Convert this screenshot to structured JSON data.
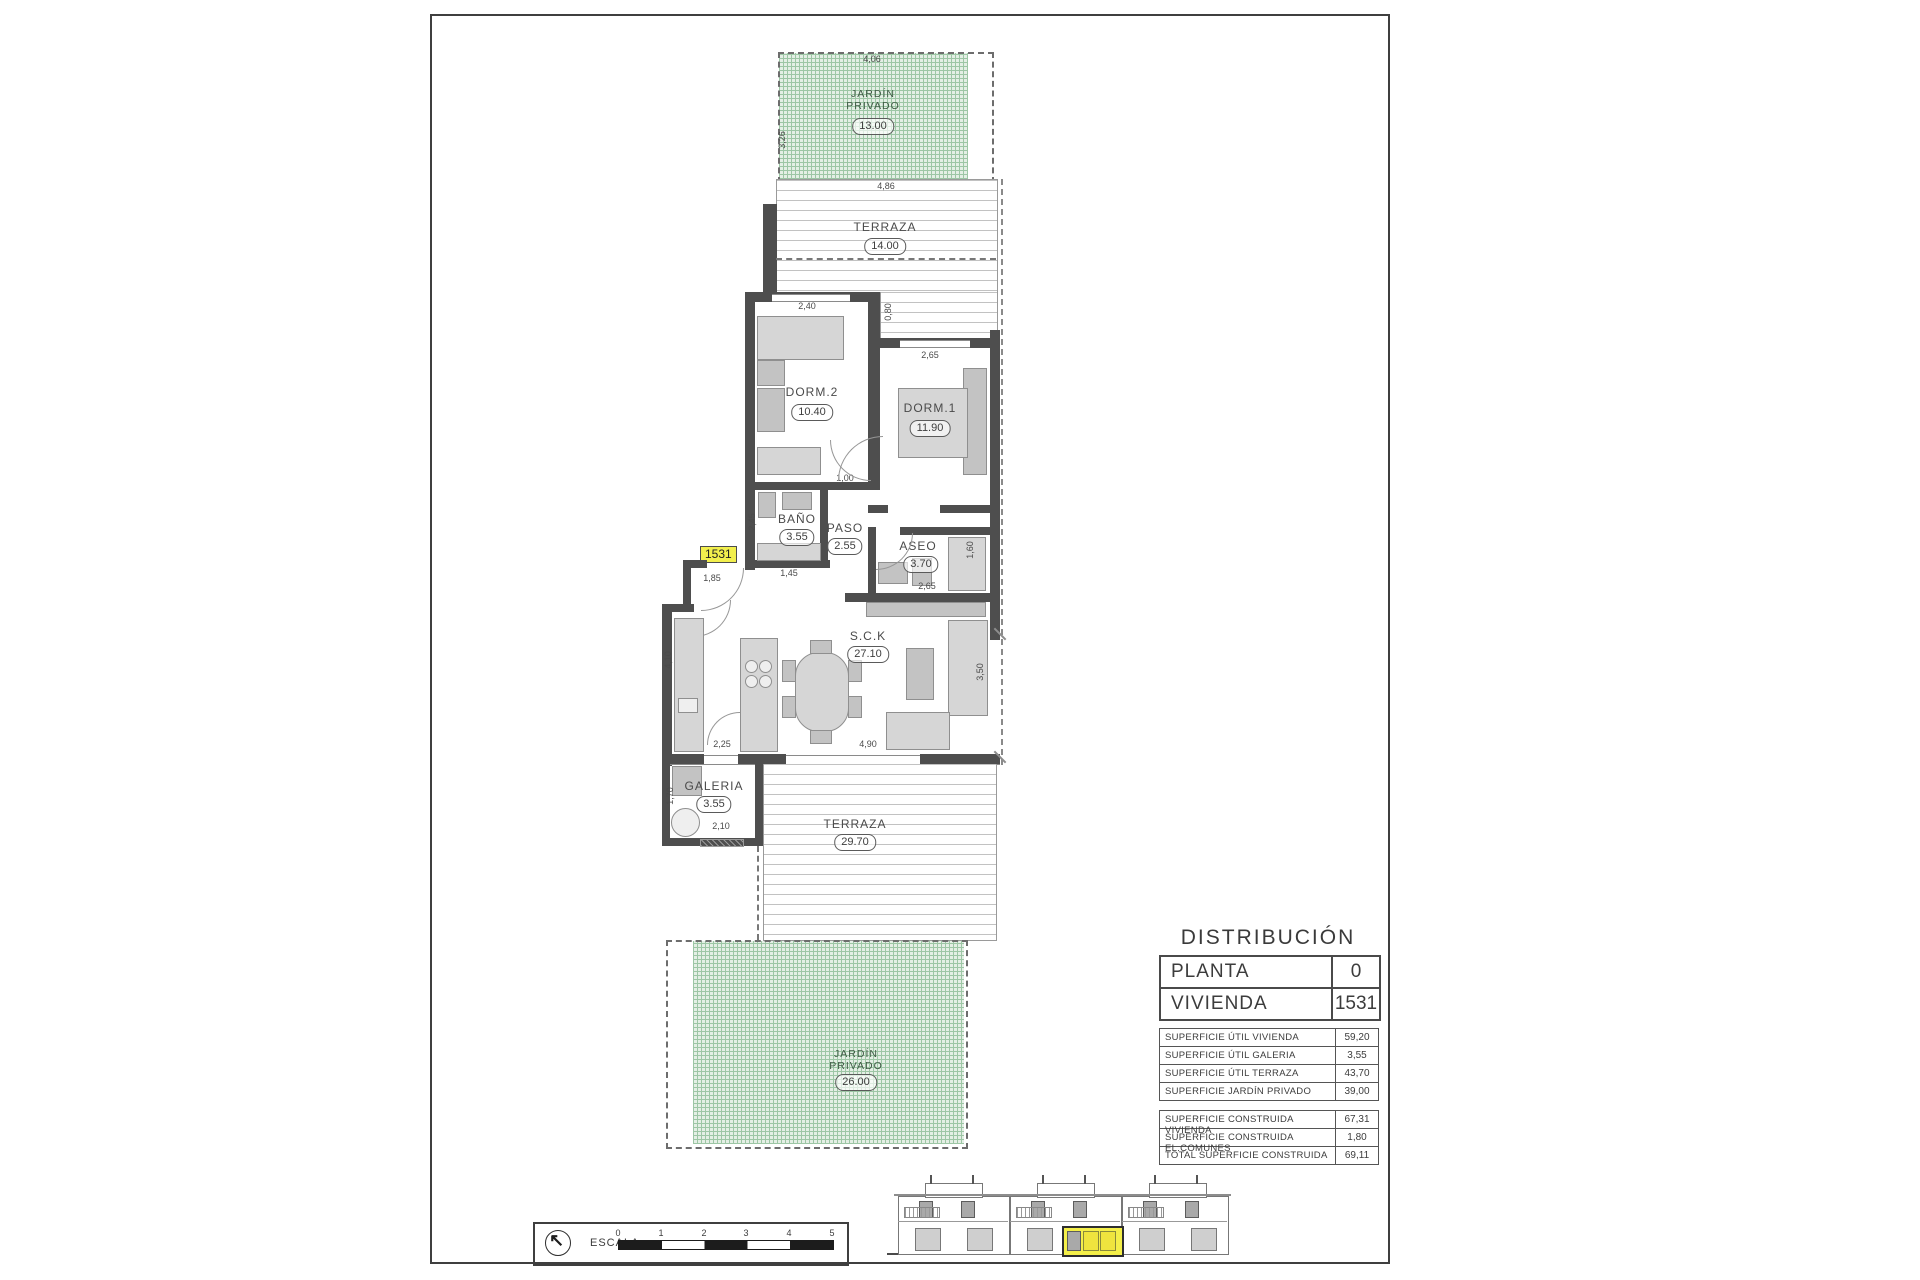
{
  "colors": {
    "highlight_yellow": "#f2ef4d",
    "garden_green": "#9dc6a5",
    "wall_dark": "#4e4e4e"
  },
  "plan": {
    "unit_tag": "1531",
    "rooms": {
      "jardin_top": {
        "name": "JARDÍN\nPRIVADO",
        "area": "13.00"
      },
      "terraza_top": {
        "name": "TERRAZA",
        "area": "14.00"
      },
      "dorm2": {
        "name": "DORM.2",
        "area": "10.40"
      },
      "dorm1": {
        "name": "DORM.1",
        "area": "11.90"
      },
      "bano": {
        "name": "BAÑO",
        "area": "3.55"
      },
      "paso": {
        "name": "PASO",
        "area": "2.55"
      },
      "aseo": {
        "name": "ASEO",
        "area": "3.70"
      },
      "sck": {
        "name": "S.C.K",
        "area": "27.10"
      },
      "galeria": {
        "name": "GALERIA",
        "area": "3.55"
      },
      "terraza_bottom": {
        "name": "TERRAZA",
        "area": "29.70"
      },
      "jardin_bottom": {
        "name": "JARDÍN\nPRIVADO",
        "area": "26.00"
      }
    },
    "dims": {
      "jardin_top_w": "4,06",
      "jardin_top_h": "3,26",
      "terraza_top_w": "4,86",
      "dorm2_w": "2,40",
      "dorm1_w": "2,65",
      "deck_d": "0,80",
      "dorm1_h": "4,60",
      "paso_door": "1,00",
      "bano_h": "2,45",
      "bano_w": "1,45",
      "entry_door": "1,85",
      "aseo_w": "2,65",
      "aseo_h": "1,60",
      "kitchen_h": "4,10",
      "kitchen_w": "2,25",
      "salon_w": "4,90",
      "salon_h": "3,50",
      "galeria_h": "1,70",
      "galeria_w": "2,10",
      "terraza_edge": "1,90"
    }
  },
  "distribution": {
    "title": "DISTRIBUCIÓN",
    "header_rows": [
      {
        "label": "PLANTA",
        "value": "0"
      },
      {
        "label": "VIVIENDA",
        "value": "1531"
      }
    ],
    "util_rows": [
      {
        "label": "SUPERFICIE ÚTIL VIVIENDA",
        "value": "59,20"
      },
      {
        "label": "SUPERFICIE ÚTIL GALERIA",
        "value": "3,55"
      },
      {
        "label": "SUPERFICIE ÚTIL TERRAZA",
        "value": "43,70"
      },
      {
        "label": "SUPERFICIE JARDÍN PRIVADO",
        "value": "39,00"
      }
    ],
    "built_rows": [
      {
        "label": "SUPERFICIE CONSTRUIDA VIVIENDA",
        "value": "67,31"
      },
      {
        "label": "SUPERFICIE CONSTRUIDA EL.COMUNES",
        "value": "1,80"
      },
      {
        "label": "TOTAL SUPERFICIE CONSTRUIDA",
        "value": "69,11"
      }
    ]
  },
  "scale_bar": {
    "label": "ESCALA :",
    "ticks": [
      "0",
      "1",
      "2",
      "3",
      "4",
      "5"
    ]
  }
}
